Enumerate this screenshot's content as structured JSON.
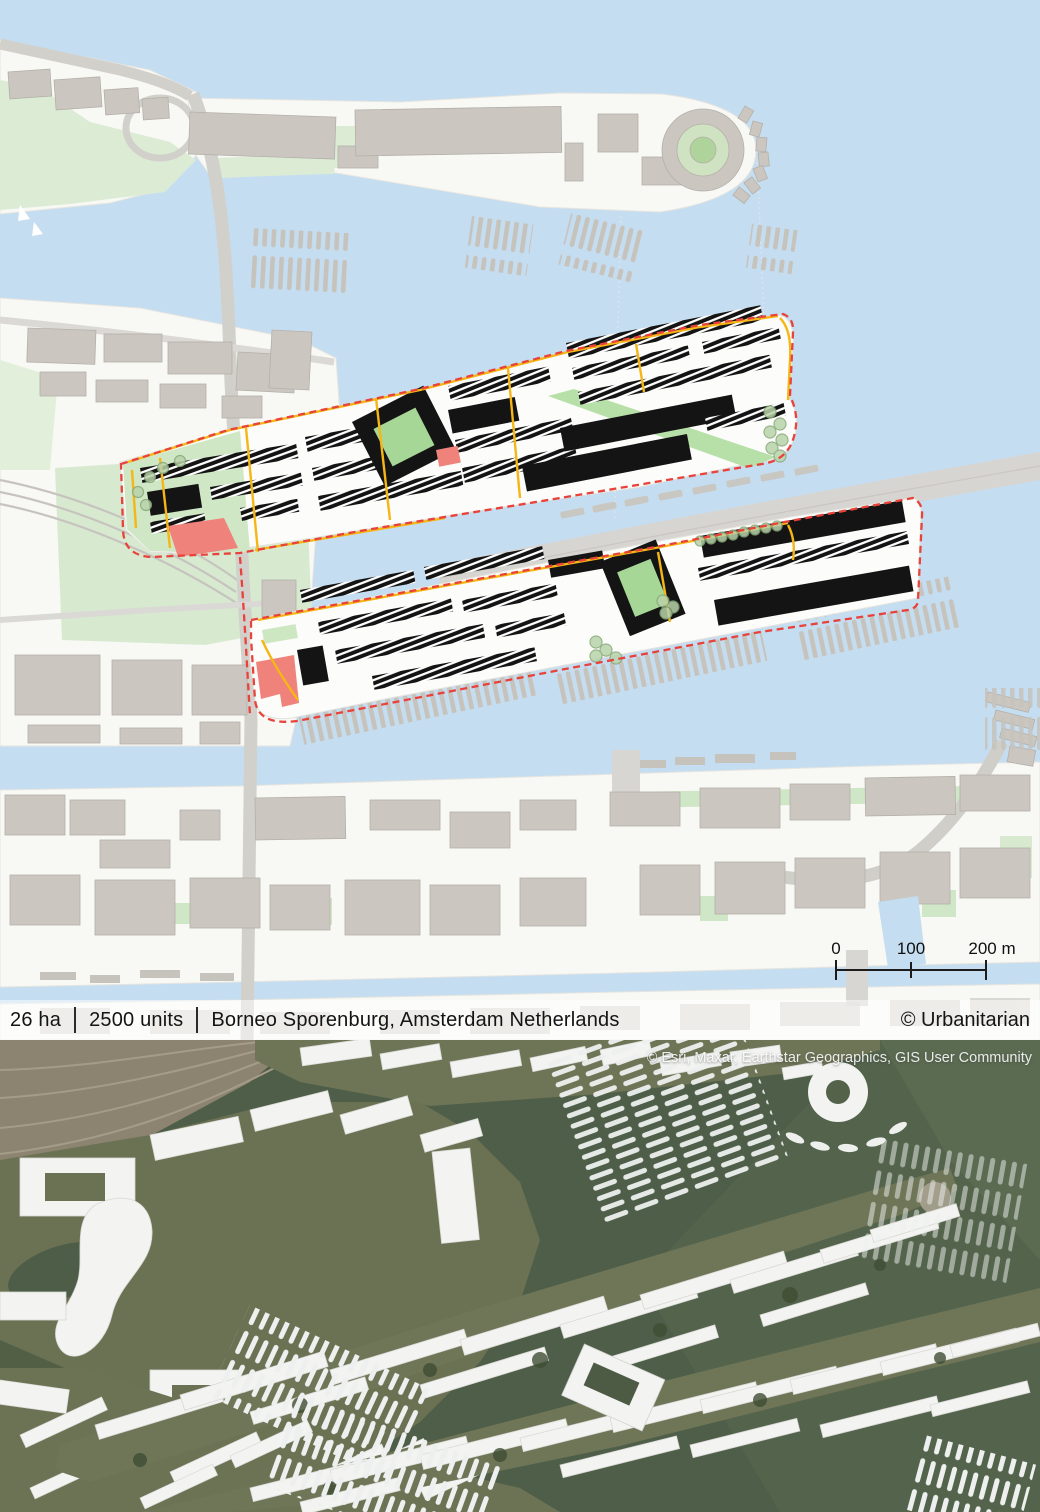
{
  "caption": {
    "area": "26 ha",
    "units": "2500 units",
    "location": "Borneo Sporenburg, Amsterdam Netherlands",
    "credit": "© Urbanitarian"
  },
  "map": {
    "scale_bar": {
      "t0": "0",
      "t100": "100",
      "t200": "200 m"
    }
  },
  "aerial": {
    "attribution": "© Esri, Maxar, Earthstar Geographics, GIS User Community"
  },
  "palette": {
    "map_water": "#c5ddf0",
    "land": "#f8f8f5",
    "context_building": "#cbc7c0",
    "project_building": "#141414",
    "boundary_red": "#e8423a",
    "road_yellow": "#f5b616",
    "accent_pink": "#ef837c",
    "park_green": "#d7ead0",
    "courtyard_green": "#a6d796",
    "aerial_water": "#4e5e48",
    "aerial_land": "#6e7456",
    "aerial_building": "#f3f3f1"
  }
}
